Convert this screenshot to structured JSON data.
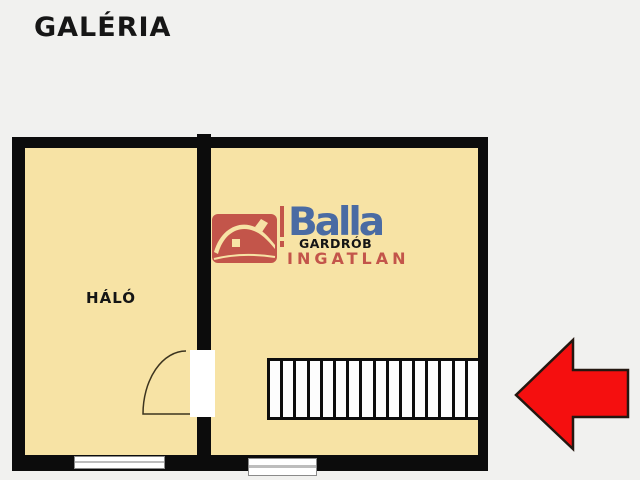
{
  "title": "GALÉRIA",
  "rooms": {
    "bedroom": {
      "label": "HÁLÓ"
    },
    "wardrobe": {
      "label": "GARDRÓB"
    }
  },
  "logo": {
    "brand": "Balla",
    "subtitle": "INGATLAN",
    "icon": "house-icon"
  },
  "stairs": {
    "steps": 16
  },
  "arrow": {
    "direction": "left"
  },
  "colors": {
    "background": "#f1f1ef",
    "floor_fill": "#f7e3a5",
    "wall": "#0c0c0c",
    "logo_red": "#c3554a",
    "logo_blue": "#4a6ba3",
    "arrow_red": "#f50f0f"
  }
}
